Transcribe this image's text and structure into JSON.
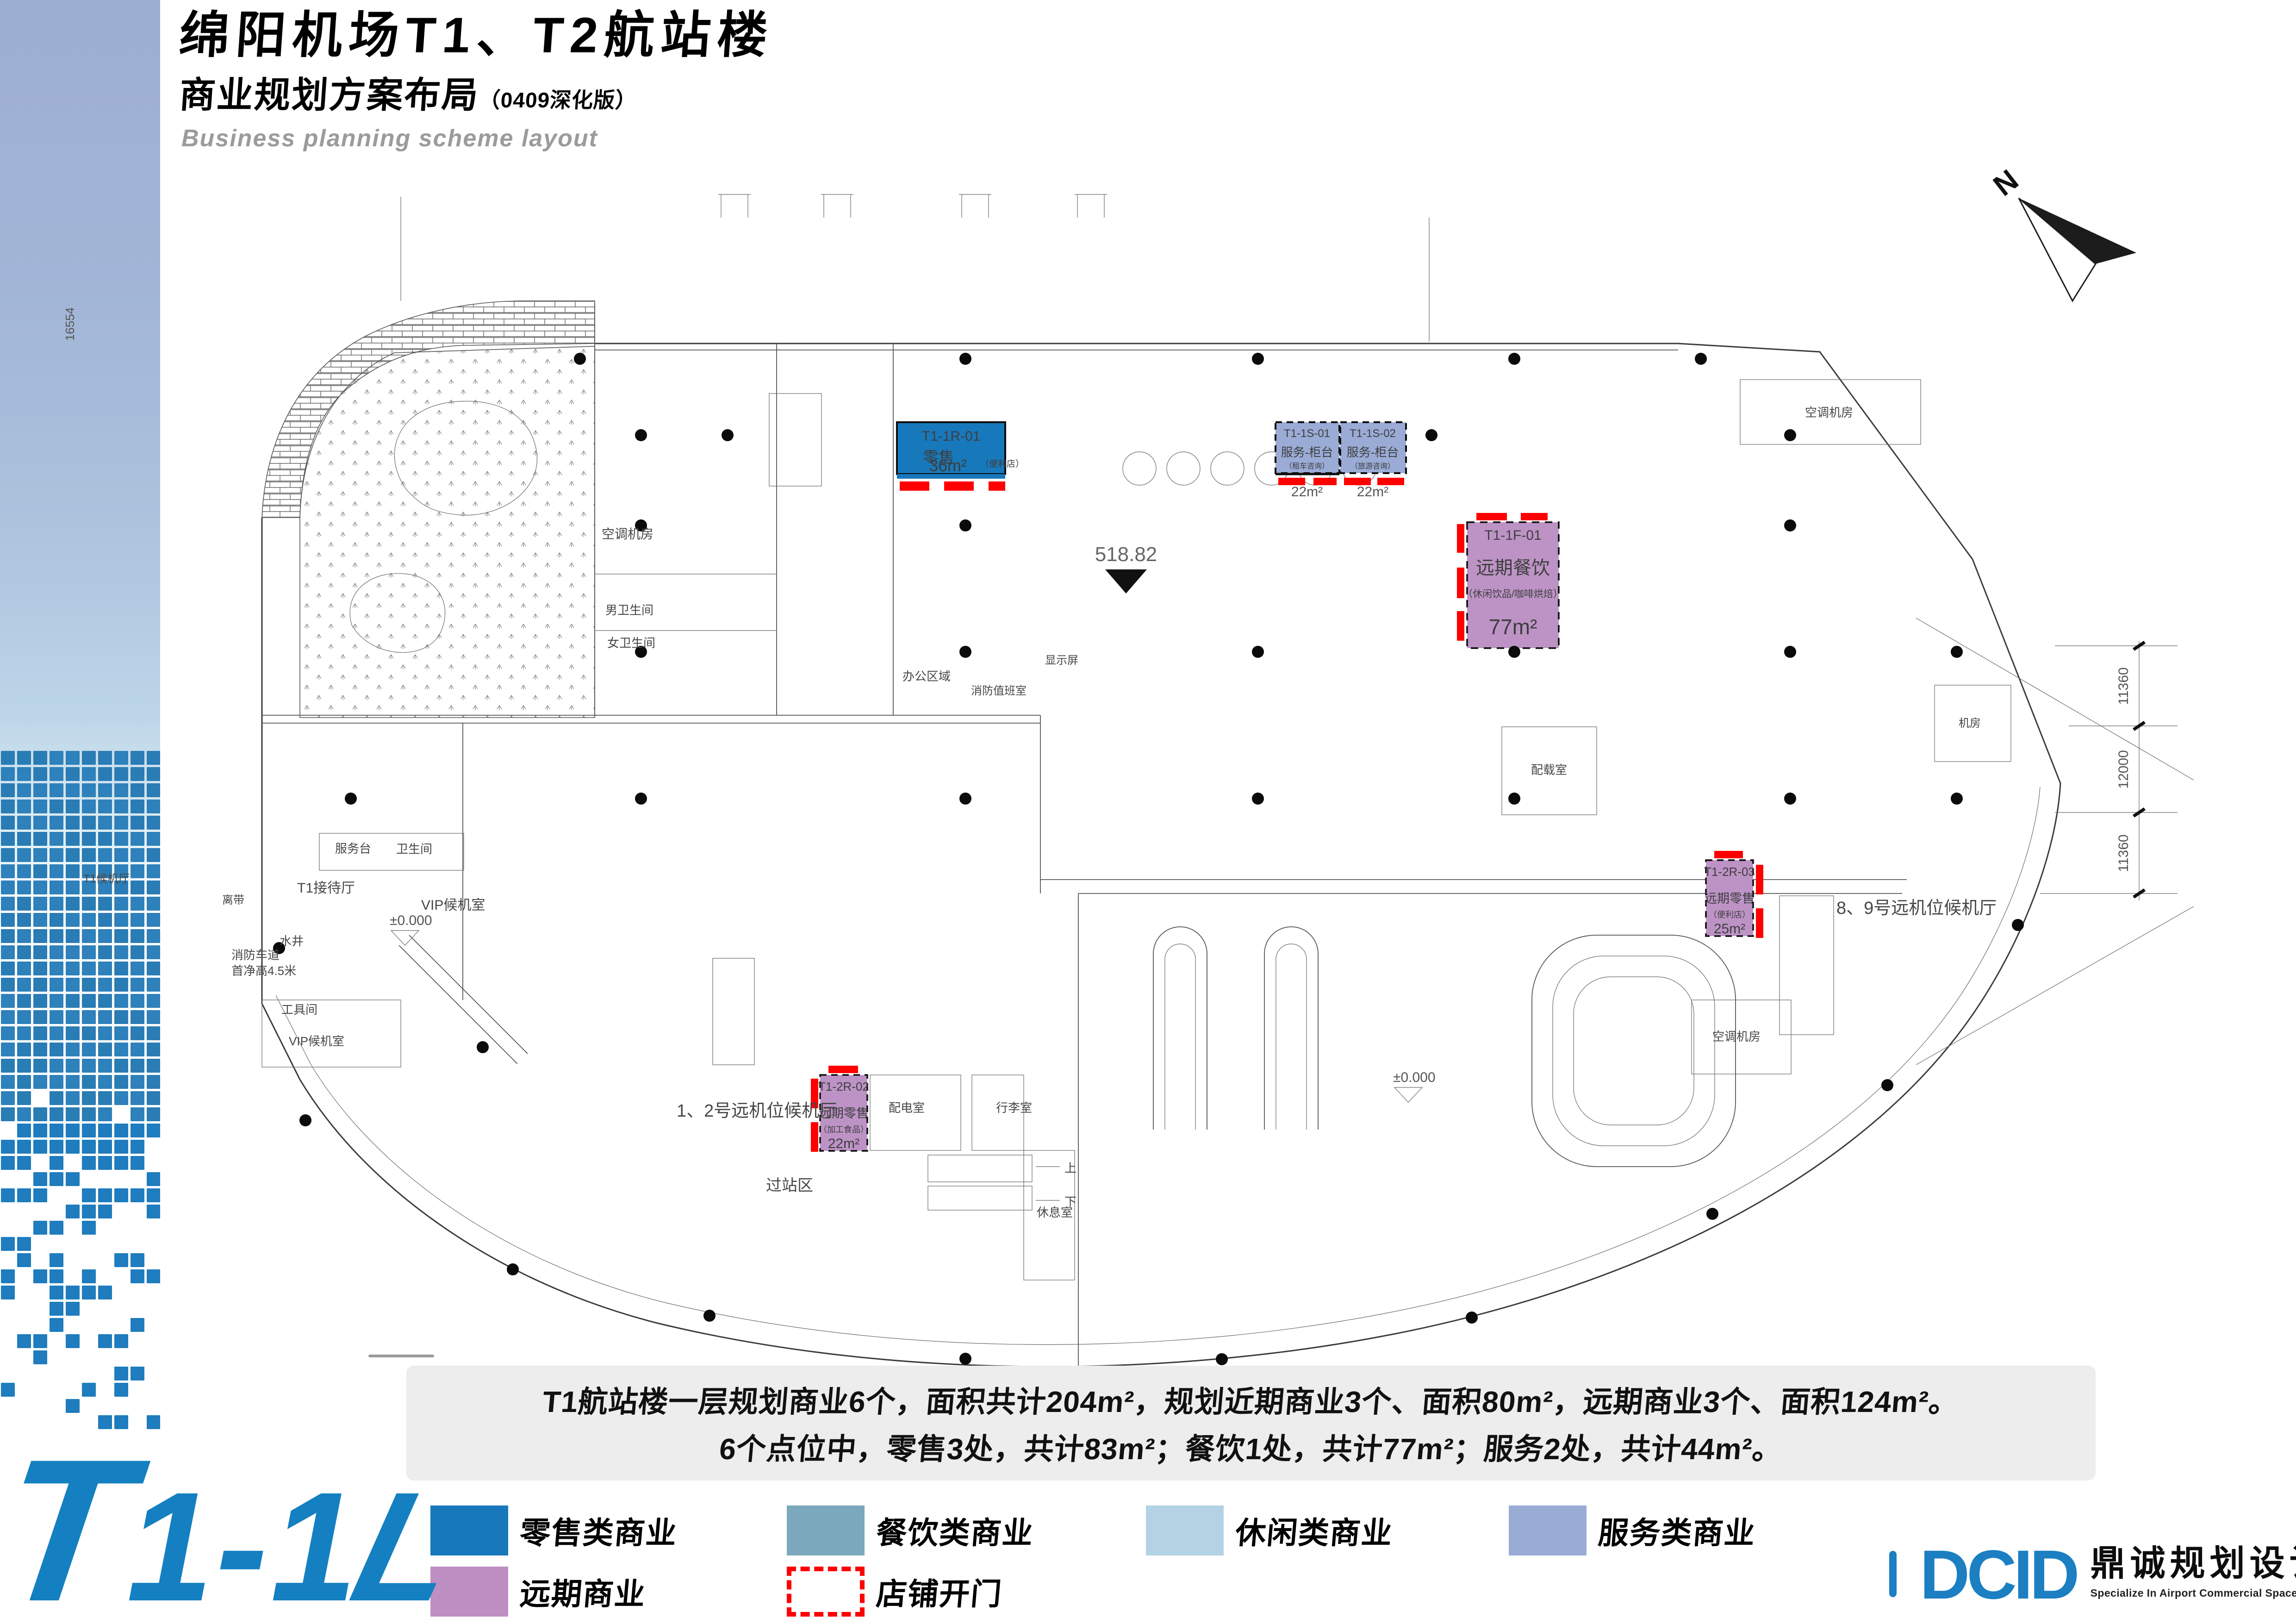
{
  "page": {
    "title": "绵阳机场T1、T2航站楼",
    "subtitle": "商业规划方案布局",
    "subtitle_note": "（0409深化版）",
    "subtitle_en": "Business planning scheme layout",
    "north_label": "N"
  },
  "plan": {
    "elevation": "518.82",
    "zero_elevation": "±0.000",
    "dims_right": [
      "11360",
      "12000",
      "11360"
    ],
    "dim_left": "16554",
    "stair_up": "上",
    "stair_down": "下",
    "shops": [
      {
        "code": "T1-1R-01",
        "name": "零售",
        "detail": "（便利店）",
        "area": "36m²",
        "color": "#1878bc"
      },
      {
        "code": "T1-1S-01",
        "name": "服务-柜台",
        "detail": "（租车咨询）",
        "area": "22m²",
        "color": "#9aabd6"
      },
      {
        "code": "T1-1S-02",
        "name": "服务-柜台",
        "detail": "（旅游咨询）",
        "area": "22m²",
        "color": "#9aabd6"
      },
      {
        "code": "T1-1F-01",
        "name": "远期餐饮",
        "detail": "（休闲饮品/咖啡烘焙）",
        "area": "77m²",
        "color": "#bd93c6"
      },
      {
        "code": "T1-2R-03",
        "name": "远期零售",
        "detail": "（便利店）",
        "area": "25m²",
        "color": "#bd93c6"
      },
      {
        "code": "T1-2R-02",
        "name": "远期零售",
        "detail": "（加工食品）",
        "area": "22m²",
        "color": "#bd93c6"
      }
    ],
    "labels": [
      {
        "text": "空调机房"
      },
      {
        "text": "男卫生间"
      },
      {
        "text": "女卫生间"
      },
      {
        "text": "服务台"
      },
      {
        "text": "卫生间"
      },
      {
        "text": "T1接待厅"
      },
      {
        "text": "VIP候机室"
      },
      {
        "text": "消防车道"
      },
      {
        "text": "首净高4.5米"
      },
      {
        "text": "水井"
      },
      {
        "text": "工具间"
      },
      {
        "text": "离带"
      },
      {
        "text": "办公区域"
      },
      {
        "text": "消防值班室"
      },
      {
        "text": "显示屏"
      },
      {
        "text": "1、2号远机位候机厅"
      },
      {
        "text": "过站区"
      },
      {
        "text": "配电室"
      },
      {
        "text": "行李室"
      },
      {
        "text": "休息室"
      },
      {
        "text": "8、9号远机位候机厅"
      },
      {
        "text": "空调机房"
      },
      {
        "text": "空调机房"
      },
      {
        "text": "配载室"
      },
      {
        "text": "机房"
      },
      {
        "text": "T1候机厅"
      },
      {
        "text": "VIP候机室"
      }
    ]
  },
  "summary": {
    "line1": "T1航站楼一层规划商业6个，面积共计204m²，规划近期商业3个、面积80m²，远期商业3个、面积124m²。",
    "line2": "6个点位中，零售3处，共计83m²；餐饮1处，共计77m²；服务2处，共计44m²。"
  },
  "legend": {
    "items": [
      {
        "label": "零售类商业",
        "color": "#1878bc"
      },
      {
        "label": "餐饮类商业",
        "color": "#7ba8bc"
      },
      {
        "label": "休闲类商业",
        "color": "#b3d2e4"
      },
      {
        "label": "服务类商业",
        "color": "#9aabd6"
      },
      {
        "label": "远期商业",
        "color": "#bd8fc3"
      },
      {
        "label": "店铺开门",
        "color": "#ff0000",
        "style": "dashed"
      }
    ]
  },
  "footer": {
    "sheet_t": "T",
    "sheet_mid": "1-1",
    "sheet_l": "L",
    "logo_text": "DCID",
    "logo_cn": "鼎诚规划设计",
    "logo_en": "Specialize In Airport Commercial Space Planning And Designing"
  },
  "colors": {
    "retail": "#1878bc",
    "dining": "#7ba8bc",
    "leisure": "#b3d2e4",
    "service": "#9aabd6",
    "future": "#bd8fc3",
    "door_open": "#ff0000",
    "accent_blue": "#157fc1"
  }
}
